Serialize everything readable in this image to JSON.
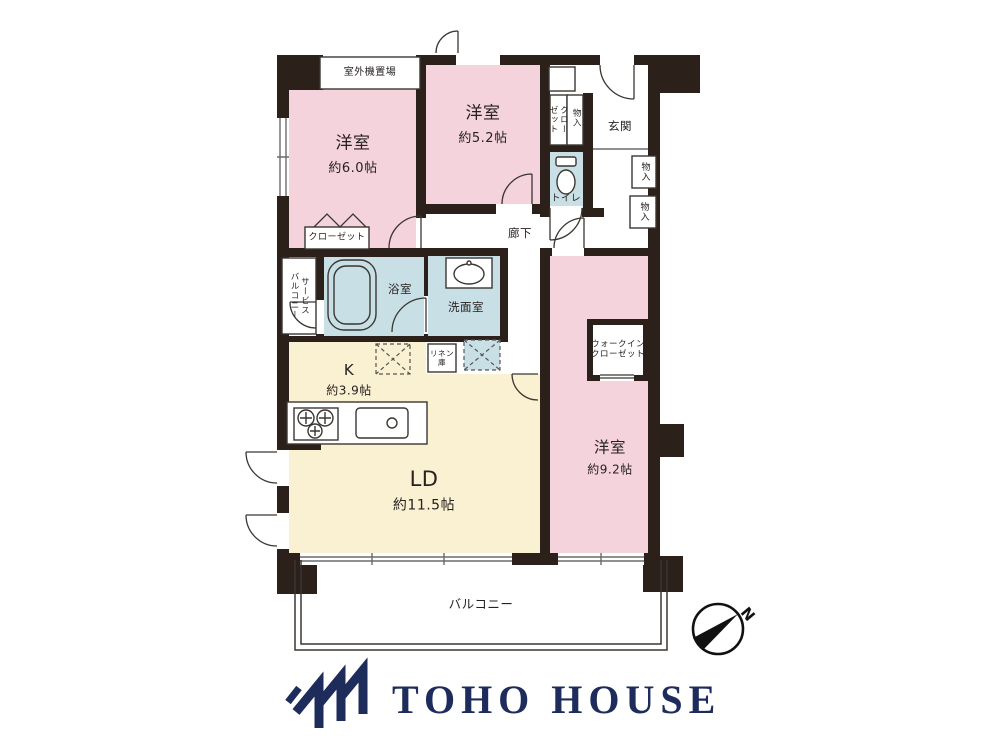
{
  "colors": {
    "wall": "#2b211a",
    "room_pink": "#f4d3dd",
    "wet_blue": "#c8dfe5",
    "ldk_cream": "#faf0d2",
    "line": "#3a3632",
    "brand_navy": "#1e2c5c"
  },
  "floorplan": {
    "outdoor_unit_label": "室外機置場",
    "bedroom1": {
      "name": "洋室",
      "size": "約6.0帖"
    },
    "bedroom2": {
      "name": "洋室",
      "size": "約5.2帖"
    },
    "bedroom3": {
      "name": "洋室",
      "size": "約9.2帖"
    },
    "kitchen": {
      "name": "K",
      "size": "約3.9帖"
    },
    "living_dining": {
      "name": "LD",
      "size": "約11.5帖"
    },
    "bathroom_label": "浴室",
    "washroom_label": "洗面室",
    "toilet_label": "トイレ",
    "entrance_label": "玄関",
    "hallway_label": "廊下",
    "balcony_label": "バルコニー",
    "service_balcony_label": "サービス\nバルコニー",
    "walk_in_closet_label": "ウォークイン\nクローゼット",
    "closet_upper_label": "クロー\nゼット",
    "closet_lower_label": "クローゼット",
    "linen_label": "リネン\n庫",
    "storage_labels": {
      "s1": "物入",
      "s2": "物入",
      "s3": "物入"
    },
    "compass_n": "N"
  },
  "footer": {
    "brand": "TOHO HOUSE"
  }
}
